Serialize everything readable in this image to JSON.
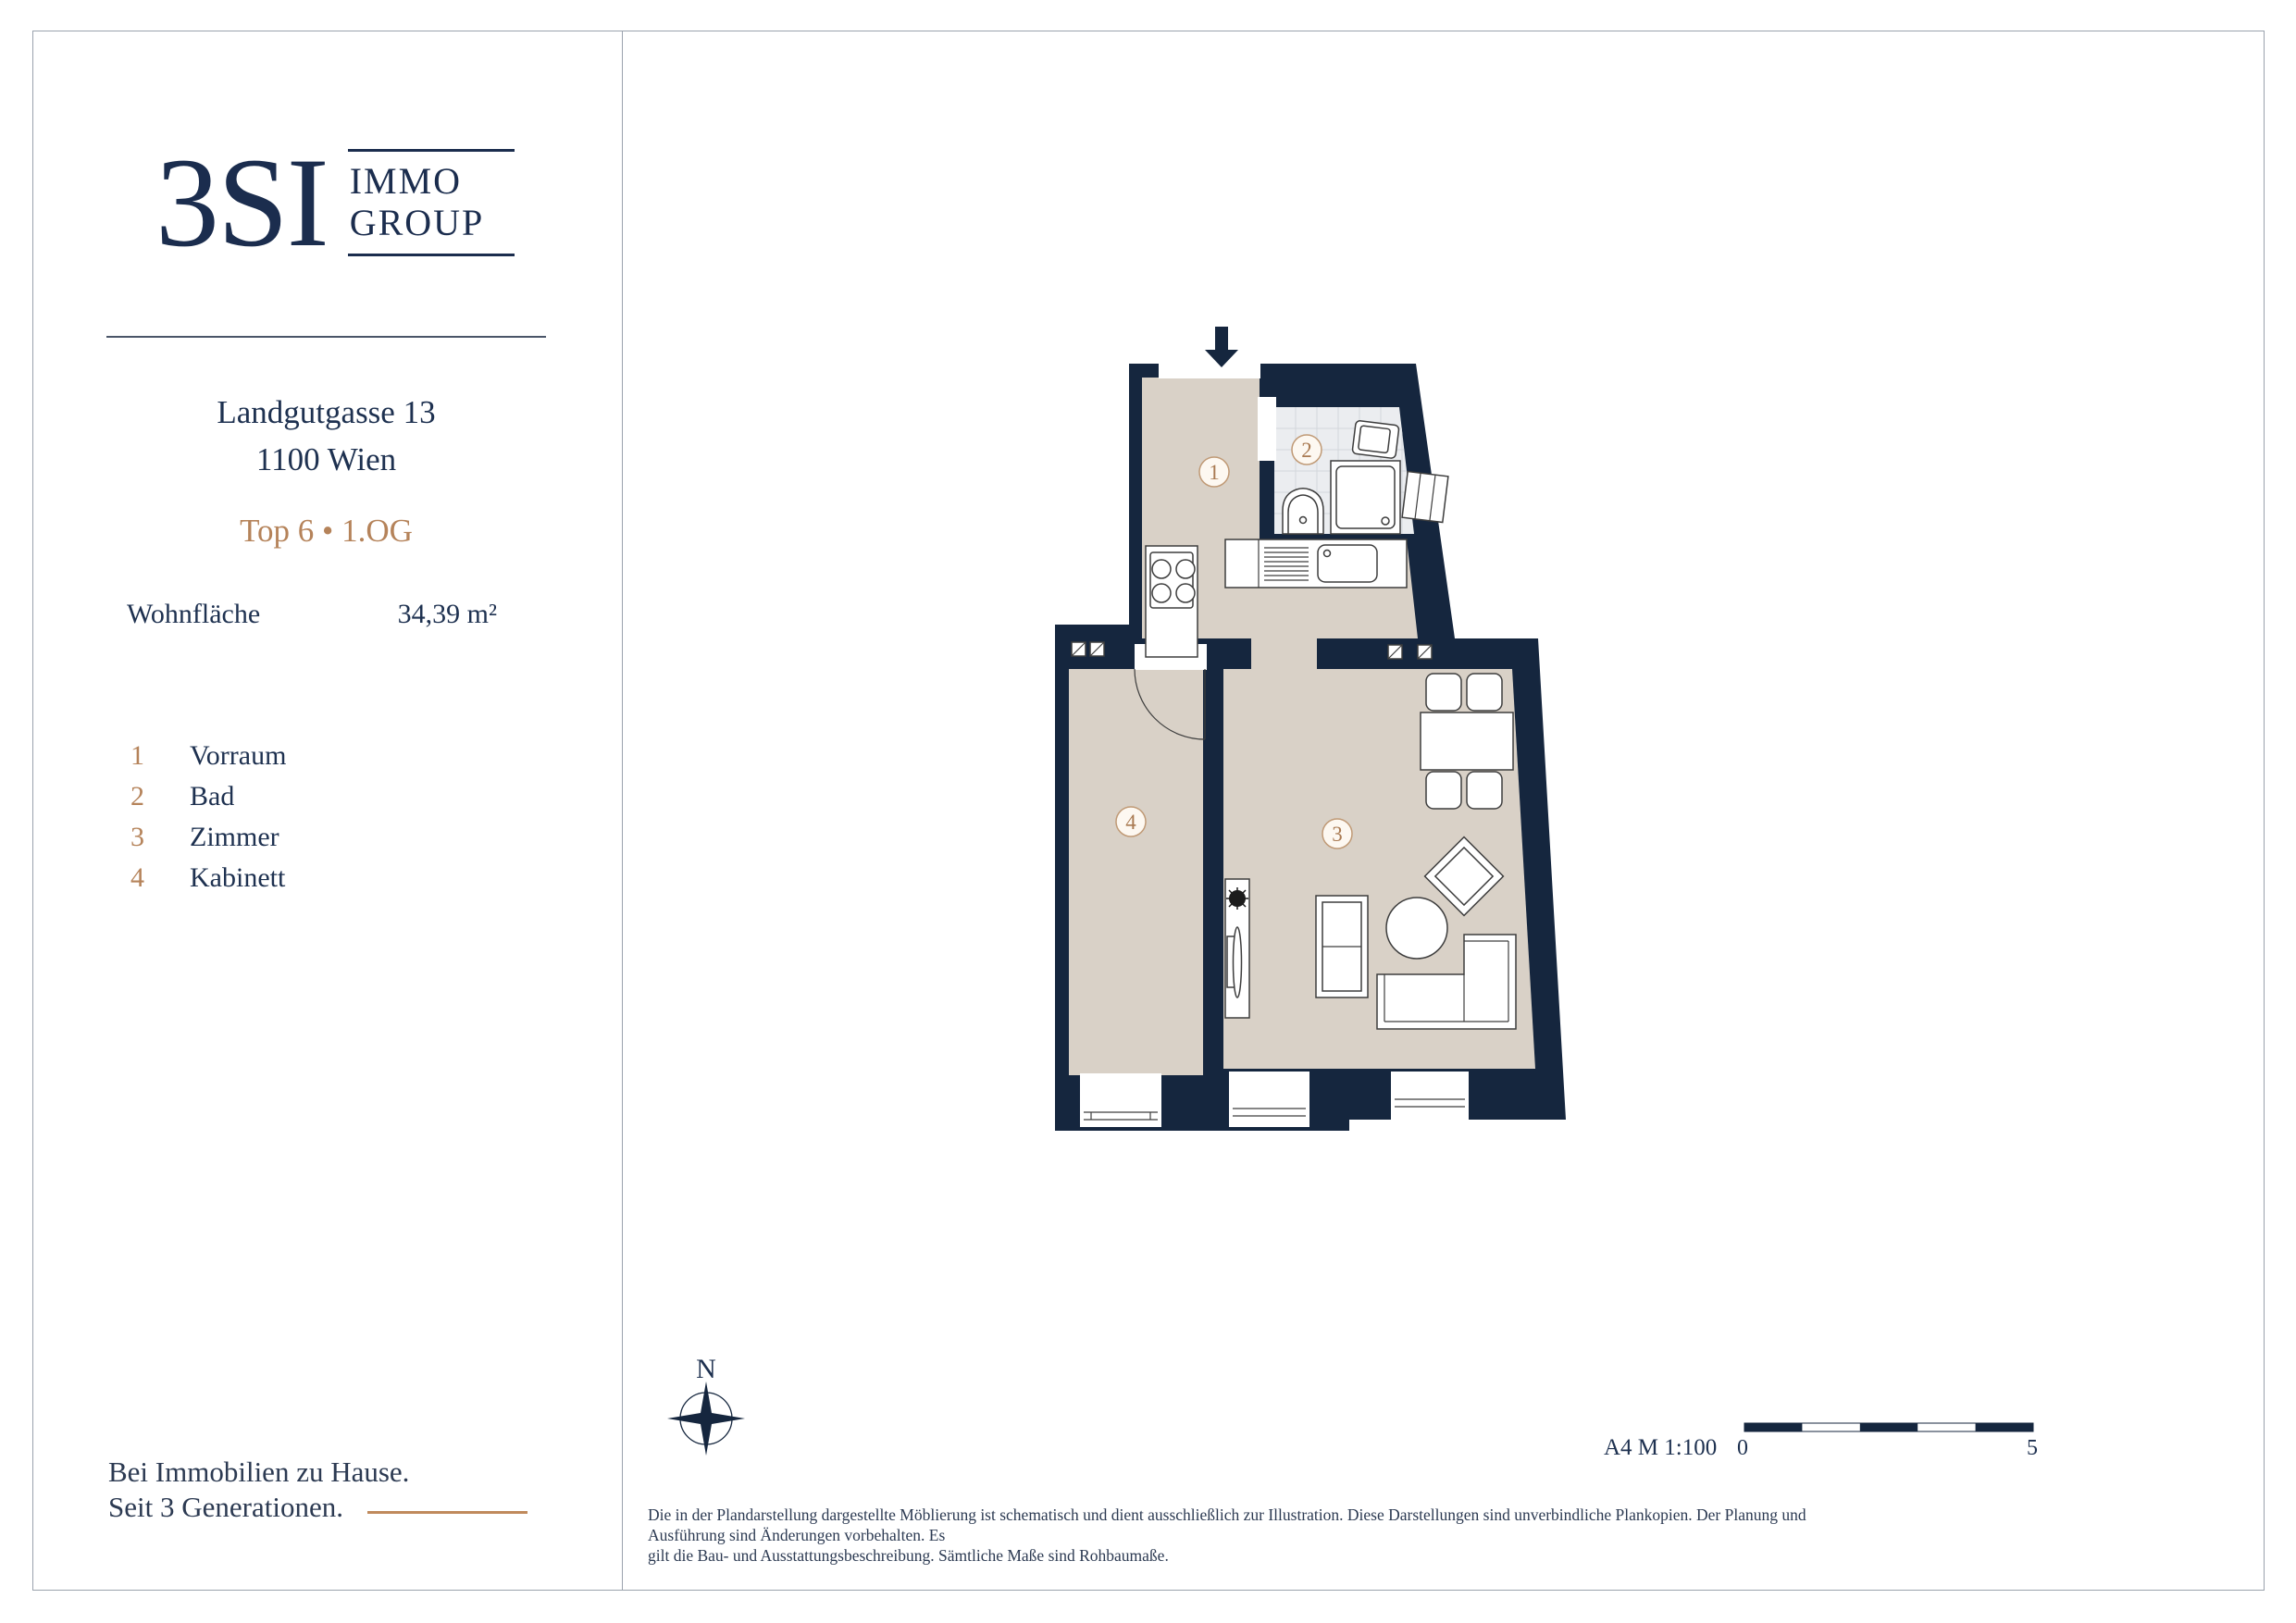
{
  "brand": {
    "logo_main": "3SI",
    "logo_sub_top": "IMMO",
    "logo_sub_bottom": "GROUP"
  },
  "property": {
    "address_line1": "Landgutgasse 13",
    "address_line2": "1100 Wien",
    "unit_line": "Top 6 • 1.OG",
    "area_label": "Wohnfläche",
    "area_value": "34,39 m²"
  },
  "legend": {
    "items": [
      {
        "num": "1",
        "label": "Vorraum"
      },
      {
        "num": "2",
        "label": "Bad"
      },
      {
        "num": "3",
        "label": "Zimmer"
      },
      {
        "num": "4",
        "label": "Kabinett"
      }
    ]
  },
  "plan": {
    "room_labels": [
      "1",
      "2",
      "3",
      "4"
    ],
    "north_label": "N",
    "scale_note": "A4  M 1:100",
    "scale_zero": "0",
    "scale_five": "5"
  },
  "footer": {
    "tagline_line1": "Bei Immobilien zu Hause.",
    "tagline_line2": "Seit 3 Generationen.",
    "disclaimer_line1": "Die in der Plandarstellung dargestellte Möblierung ist schematisch und dient ausschließlich zur Illustration. Diese Darstellungen sind unverbindliche Plankopien. Der Planung und Ausführung sind Änderungen vorbehalten. Es",
    "disclaimer_line2": "gilt die Bau- und Ausstattungsbeschreibung. Sämtliche Maße sind Rohbaumaße."
  },
  "colors": {
    "navy": "#1e3150",
    "wall": "#15263e",
    "copper": "#b5835a",
    "floor_beige": "#d9d1c7",
    "tile": "#ebedf0"
  }
}
